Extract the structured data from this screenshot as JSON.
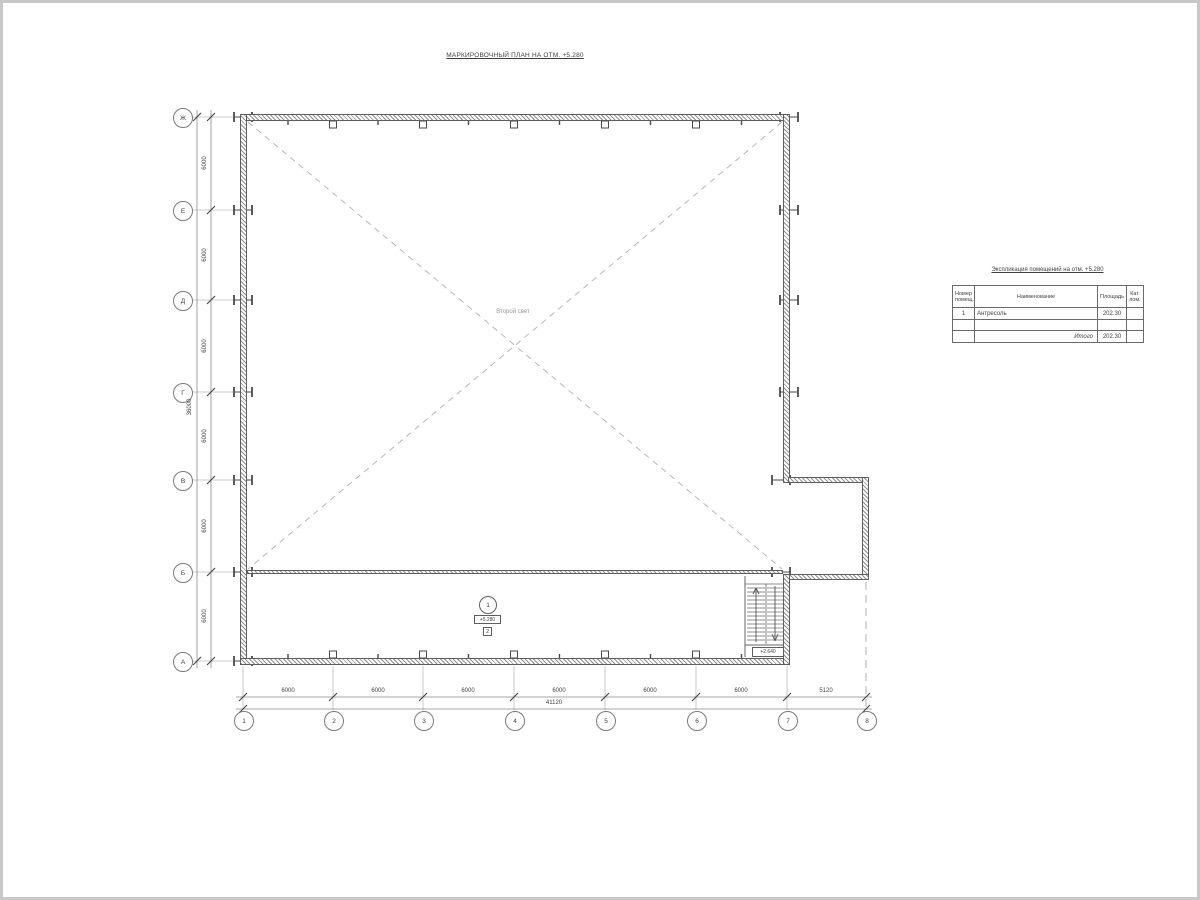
{
  "sheet": {
    "title": "МАРКИРОВОЧНЫЙ ПЛАН НА ОТМ. +5.280"
  },
  "colors": {
    "line": "#5e5e5e",
    "light_line": "#bcbcbc",
    "text": "#3f3f3f"
  },
  "axes": {
    "rows": [
      "Ж",
      "Е",
      "Д",
      "Г",
      "В",
      "Б",
      "А"
    ],
    "cols": [
      "1",
      "2",
      "3",
      "4",
      "5",
      "6",
      "7",
      "8"
    ]
  },
  "dims": {
    "left_segments": [
      "6000",
      "6000",
      "6000",
      "6000",
      "6000",
      "6000"
    ],
    "left_total": "36000",
    "bottom_segments": [
      "6000",
      "6000",
      "6000",
      "6000",
      "6000",
      "6000",
      "5120"
    ],
    "bottom_total": "41120"
  },
  "plan": {
    "void_label": "Второй свет",
    "room_number": "1",
    "room_elevation": "+5.280",
    "floor_type_mark": "2",
    "stair_landing_elevation": "+2.640"
  },
  "table": {
    "title": "Экспликация помещений на отм. +5.280",
    "headers": {
      "number": "Номер помещ.",
      "name": "Наименование",
      "area": "Площадь",
      "category": "Кат. пом."
    },
    "rows": [
      {
        "number": "1",
        "name": "Антресоль",
        "area": "202.30",
        "category": ""
      }
    ],
    "total_label": "Итого",
    "total_area": "202.30"
  }
}
